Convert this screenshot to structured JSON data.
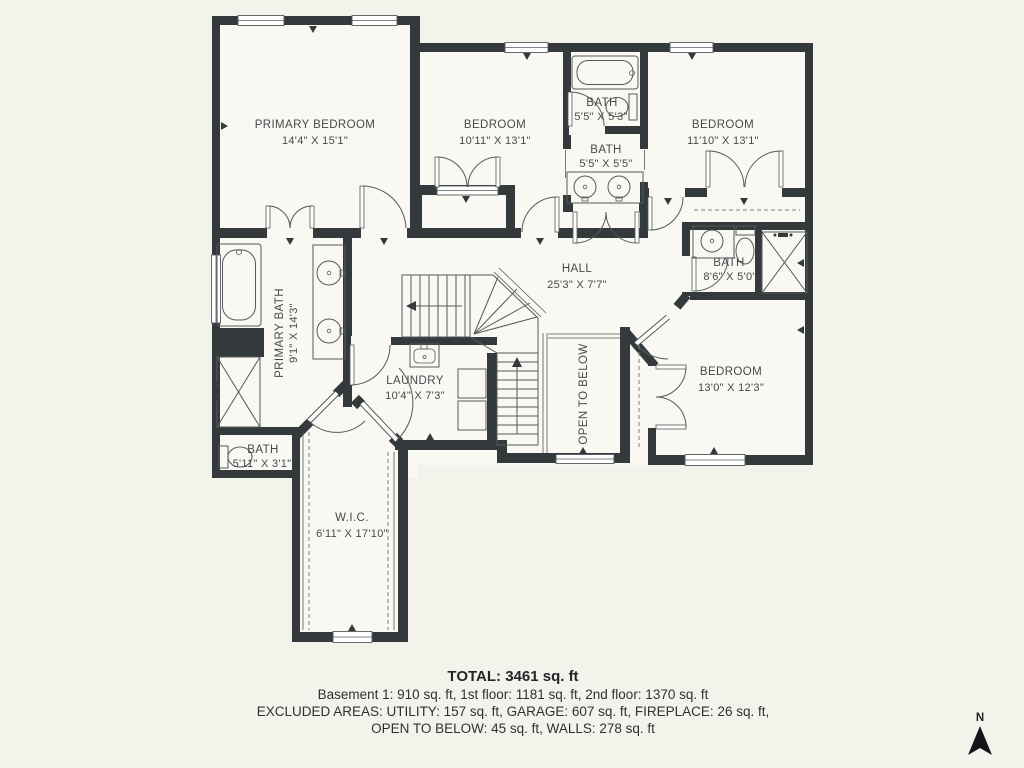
{
  "plan": {
    "rooms": [
      {
        "name": "PRIMARY BEDROOM",
        "dims": "14'4\" X 15'1\""
      },
      {
        "name": "BEDROOM",
        "dims": "10'11\" X 13'1\""
      },
      {
        "name": "BATH",
        "dims": "5'5\" X 5'3\""
      },
      {
        "name": "BATH",
        "dims": "5'5\" X 5'5\""
      },
      {
        "name": "BEDROOM",
        "dims": "11'10\" X 13'1\""
      },
      {
        "name": "PRIMARY BATH",
        "dims": "9'1\" X 14'3\""
      },
      {
        "name": "HALL",
        "dims": "25'3\" X 7'7\""
      },
      {
        "name": "BATH",
        "dims": "8'6\" X 5'0\""
      },
      {
        "name": "BEDROOM",
        "dims": "13'0\" X 12'3\""
      },
      {
        "name": "LAUNDRY",
        "dims": "10'4\" X 7'3\""
      },
      {
        "name": "OPEN TO BELOW",
        "dims": ""
      },
      {
        "name": "BATH",
        "dims": "5'11\" X 3'1\""
      },
      {
        "name": "W.I.C.",
        "dims": "6'11\" X 17'10\""
      }
    ],
    "summary": {
      "total": "TOTAL: 3461 sq. ft",
      "floors": "Basement 1: 910 sq. ft, 1st floor: 1181 sq. ft, 2nd floor: 1370 sq. ft",
      "excluded1": "EXCLUDED AREAS: UTILITY: 157 sq. ft, GARAGE: 607 sq. ft, FIREPLACE: 26 sq. ft,",
      "excluded2": "OPEN TO BELOW: 45 sq. ft, WALLS: 278 sq. ft"
    },
    "compass": "N",
    "colors": {
      "background": "#f4f3eb",
      "wall": "#343a3b",
      "line": "#555a5c",
      "text": "#454b4d"
    }
  }
}
